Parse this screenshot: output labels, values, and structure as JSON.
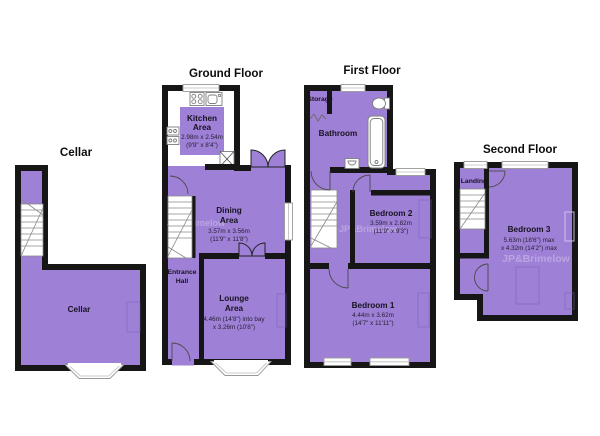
{
  "watermark": {
    "text": "JP&Brimelow"
  },
  "colors": {
    "room_fill": "#9e80d6",
    "wall": "#161616",
    "background": "#ffffff"
  },
  "floors": {
    "cellar": {
      "title": "Cellar",
      "room": {
        "name": "Cellar"
      }
    },
    "ground": {
      "title": "Ground Floor",
      "kitchen": {
        "l1": "Kitchen",
        "l2": "Area",
        "d1": "2.98m x 2.54m",
        "d2": "(9'9\" x 8'4\")"
      },
      "dining": {
        "l1": "Dining",
        "l2": "Area",
        "d1": "3.57m x 3.56m",
        "d2": "(11'9\" x 11'8\")"
      },
      "entrance": {
        "l1": "Entrance",
        "l2": "Hall"
      },
      "lounge": {
        "l1": "Lounge",
        "l2": "Area",
        "d1": "4.46m (14'8\") into bay",
        "d2": "x 3.26m (10'8\")"
      }
    },
    "first": {
      "title": "First Floor",
      "storage": {
        "name": "Storage"
      },
      "bathroom": {
        "name": "Bathroom"
      },
      "bedroom2": {
        "name": "Bedroom 2",
        "d1": "3.59m x 2.82m",
        "d2": "(11'9\" x 9'3\")"
      },
      "bedroom1": {
        "name": "Bedroom 1",
        "d1": "4.44m x 3.62m",
        "d2": "(14'7\" x 11'11\")"
      }
    },
    "second": {
      "title": "Second Floor",
      "landing": {
        "name": "Landing"
      },
      "bedroom3": {
        "name": "Bedroom 3",
        "d1": "5.63m (18'6\") max",
        "d2": "x 4.32m (14'2\") max"
      }
    }
  }
}
